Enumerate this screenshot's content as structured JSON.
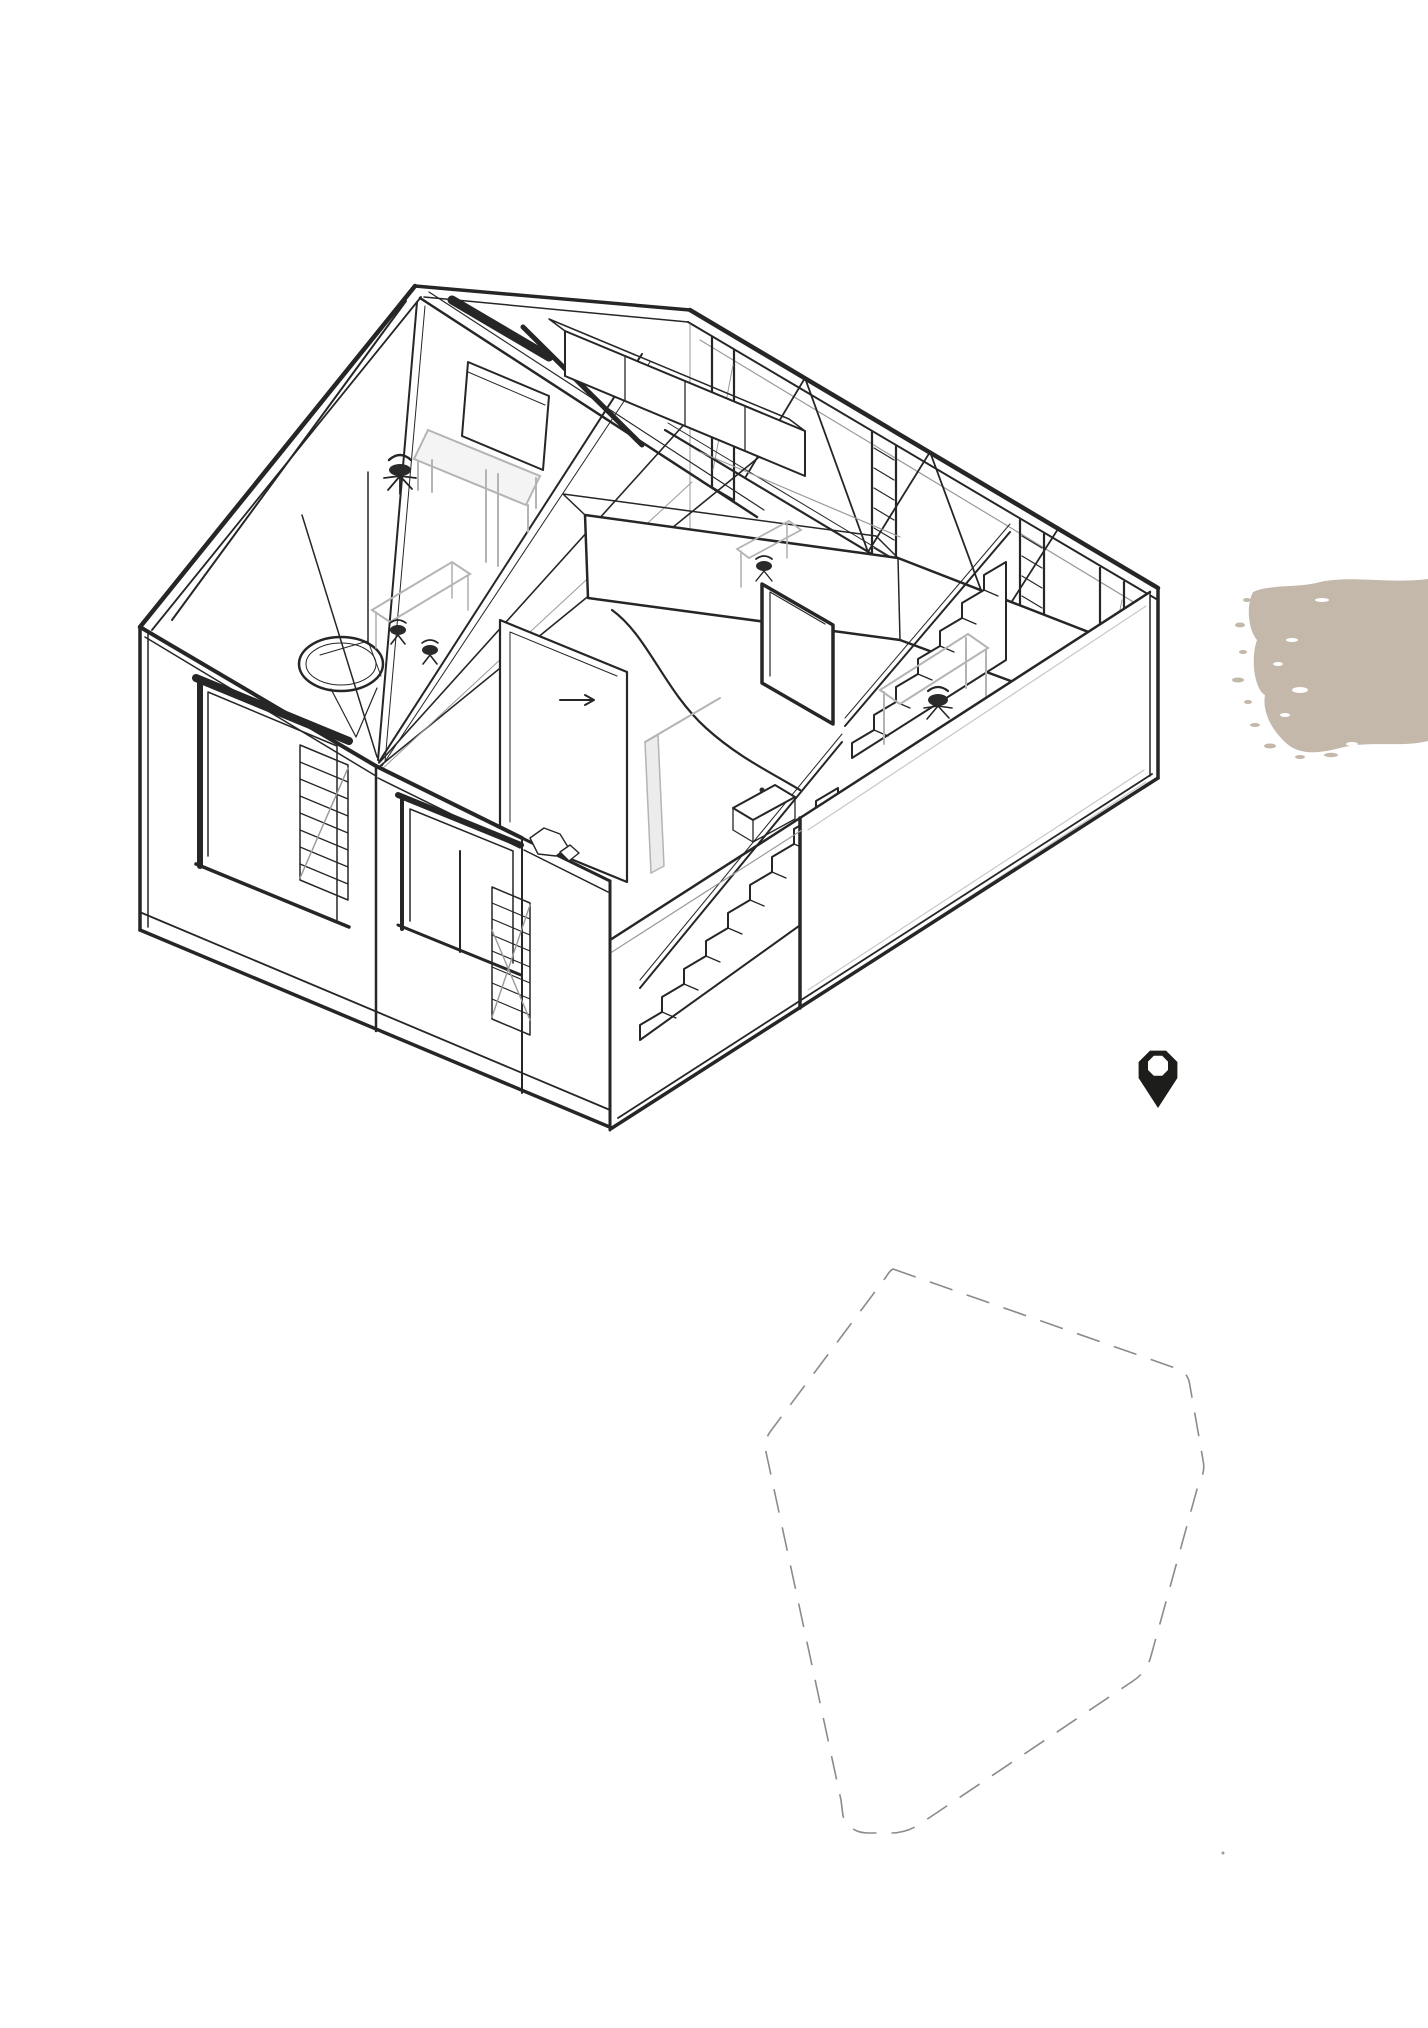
{
  "page": {
    "background_color": "#ffffff",
    "kind": "architectural presentation sheet"
  },
  "drawing": {
    "label": "axonometric cutaway house",
    "description": "Black ink axonometric cutaway drawing of a two-storey gabled house: cut facade walls with louvered windows, central switchback staircase with curved handrail, exposed roof trusses and rafters, attic desk with chair, cabinet row, hanging ring lamp, sliding door with arrow annotation, small tables, chairs and a basin in the right rooms",
    "ink_color": "#262626",
    "furniture_line_color": "#b4b4b4",
    "detail_gray_color": "#9a9a9a"
  },
  "paint_swatch": {
    "label": "beige brush-stroke swatch",
    "color": "#c4b8ab"
  },
  "location_pin": {
    "label": "map location pin",
    "color": "#1d1d1b"
  },
  "site_outline": {
    "label": "dashed site boundary polygon",
    "stroke_color": "#8b8b8b",
    "dash_pattern": "24 15"
  },
  "artifact_dot": {
    "color": "#9a9a9a"
  }
}
